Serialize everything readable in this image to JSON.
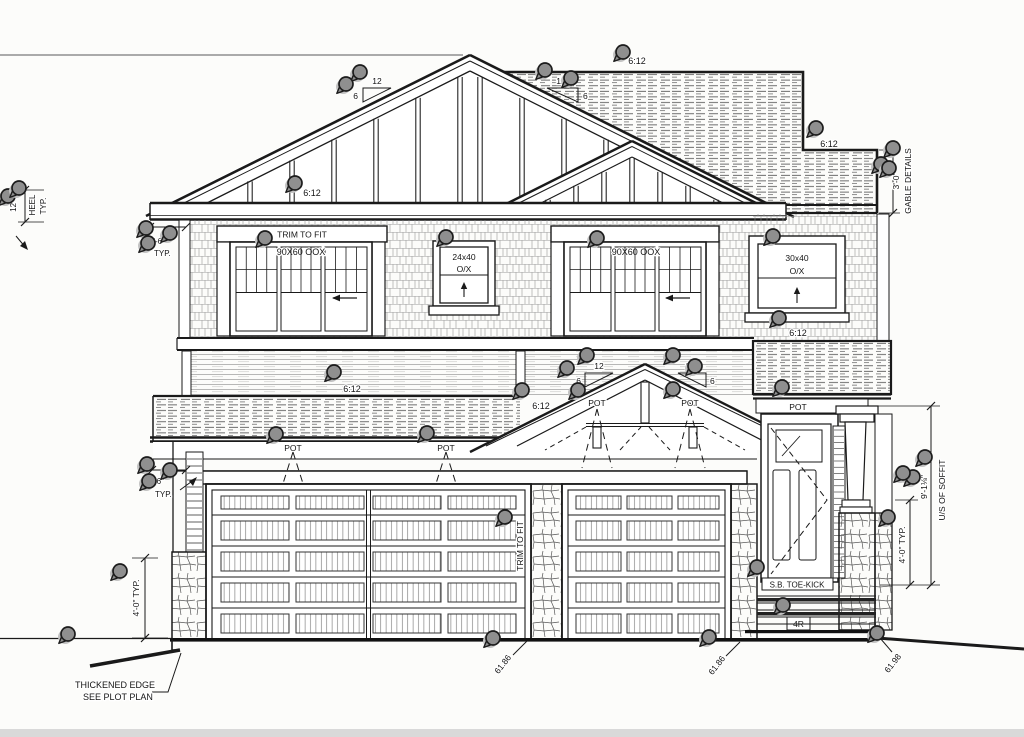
{
  "drawing": {
    "type": "house front elevation blueprint",
    "background": "#fcfcfa",
    "ink": "#1a1a1a",
    "labels": {
      "pitch": "6:12",
      "slope_run": "12",
      "slope_rise": "6",
      "pot_light": "POT",
      "typ": "TYP.",
      "trim_to_fit": "TRIM TO FIT",
      "window_large": "90X60 OOX",
      "window_small_left": "24x40",
      "window_small_right": "30x40",
      "window_operation": "O/X",
      "heel_height": "12\"",
      "heel": "HEEL",
      "eave_overhang": "1'-6\"",
      "gable_height": "3'-0\"",
      "gable_details": "GABLE DETAILS",
      "soffit_height": "9'-1⅛\"",
      "underside_soffit": "U/S OF SOFFIT",
      "four_foot_typ": "4'-0\" TYP.",
      "toe_kick": "S.B. TOE-KICK",
      "stair_risers": "4R",
      "grade_elevation_main": "61.86",
      "grade_elevation_right": "61.98",
      "thickened_edge_line1": "THICKENED EDGE",
      "thickened_edge_line2": "SEE PLOT PLAN"
    },
    "markers": {
      "style": "map-pin",
      "fill": "#8f8f8f",
      "count": 46,
      "positions": [
        [
          360,
          72
        ],
        [
          346,
          84
        ],
        [
          545,
          70
        ],
        [
          571,
          78
        ],
        [
          623,
          52
        ],
        [
          816,
          128
        ],
        [
          893,
          148
        ],
        [
          881,
          164
        ],
        [
          889,
          168
        ],
        [
          295,
          183
        ],
        [
          8,
          196
        ],
        [
          19,
          188
        ],
        [
          146,
          228
        ],
        [
          170,
          233
        ],
        [
          148,
          243
        ],
        [
          265,
          238
        ],
        [
          446,
          237
        ],
        [
          597,
          238
        ],
        [
          773,
          236
        ],
        [
          779,
          318
        ],
        [
          334,
          372
        ],
        [
          276,
          434
        ],
        [
          427,
          433
        ],
        [
          587,
          355
        ],
        [
          567,
          368
        ],
        [
          673,
          355
        ],
        [
          695,
          366
        ],
        [
          522,
          390
        ],
        [
          578,
          390
        ],
        [
          673,
          389
        ],
        [
          782,
          387
        ],
        [
          925,
          457
        ],
        [
          913,
          477
        ],
        [
          903,
          473
        ],
        [
          888,
          517
        ],
        [
          147,
          464
        ],
        [
          170,
          470
        ],
        [
          149,
          481
        ],
        [
          120,
          571
        ],
        [
          68,
          634
        ],
        [
          505,
          517
        ],
        [
          493,
          638
        ],
        [
          709,
          637
        ],
        [
          757,
          567
        ],
        [
          783,
          605
        ],
        [
          877,
          633
        ]
      ]
    }
  }
}
